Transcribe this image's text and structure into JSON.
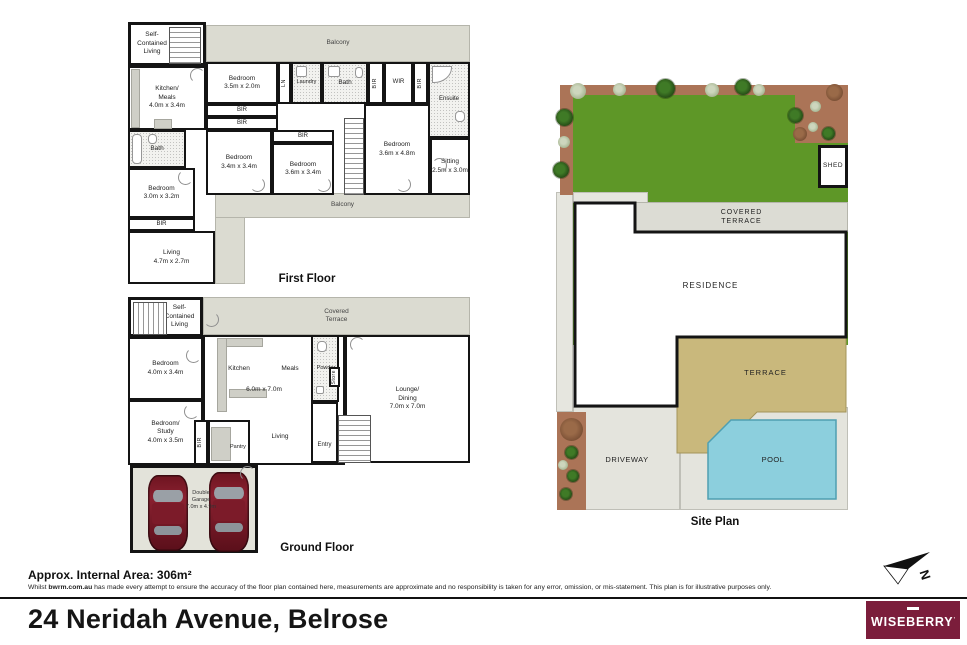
{
  "colors": {
    "wall": "#141414",
    "balcony_grey": "#dbdbd1",
    "grass_green": "#5e9727",
    "garden_brown": "#ab7457",
    "terrace_tan": "#c9b87c",
    "pool_blue": "#8ccfdd",
    "driveway_grey": "#e4e4dd",
    "car_maroon": "#6d1420",
    "logo_maroon": "#7b1d3b"
  },
  "first_floor": {
    "title": "First Floor",
    "rooms": {
      "self_contained": "Self-\nContained\nLiving",
      "balcony_top": "Balcony",
      "kitchen_meals": "Kitchen/\nMeals\n4.0m x 3.4m",
      "bedroom1": "Bedroom\n3.5m x 2.0m",
      "ln": "LN",
      "laundry": "Laundry",
      "bath_mid": "Bath",
      "bir1": "BIR",
      "wir": "WIR",
      "bir2": "BIR",
      "ensuite": "Ensuite",
      "bir_a": "BIR",
      "bir_b": "BIR",
      "bir_c": "BIR",
      "bedroom2": "Bedroom\n3.4m x 3.4m",
      "bedroom3": "Bedroom\n3.6m x 3.4m",
      "bedroom4": "Bedroom\n3.6m x 4.8m",
      "sitting": "Sitting\n2.5m x 3.0m",
      "bath_left": "Bath",
      "bedroom5": "Bedroom\n3.0m x 3.2m",
      "bir_d": "BIR",
      "living": "Living\n4.7m x 2.7m",
      "balcony_bottom": "Balcony"
    }
  },
  "ground_floor": {
    "title": "Ground Floor",
    "rooms": {
      "self_contained": "Self-\nContained\nLiving",
      "covered_terrace": "Covered\nTerrace",
      "bedroom": "Bedroom\n4.0m x 3.4m",
      "kitchen": "Kitchen",
      "meals": "Meals",
      "open_dim": "6.0m x 7.0m",
      "powder": "Powder",
      "store": "Store",
      "lounge_dining": "Lounge/\nDining\n7.0m x 7.0m",
      "bedroom_study": "Bedroom/\nStudy\n4.0m x 3.5m",
      "bir": "BIR",
      "pantry": "Pantry",
      "living": "Living",
      "entry": "Entry",
      "garage": "Double\nGarage\n7.0m x 4.9m"
    }
  },
  "site_plan": {
    "title": "Site Plan",
    "labels": {
      "shed": "SHED",
      "covered_terrace": "COVERED\nTERRACE",
      "residence": "RESIDENCE",
      "terrace": "TERRACE",
      "driveway": "DRIVEWAY",
      "pool": "POOL"
    },
    "north_label": "N"
  },
  "footer": {
    "area": "Approx. Internal Area: 306m²",
    "disclaimer_prefix": "Whilst ",
    "disclaimer_bold": "bwrm.com.au",
    "disclaimer_rest": " has made every attempt to ensure the accuracy of the floor plan contained here, measurements are approximate and no responsibility is taken for any error, omission, or mis-statement. This plan is for illustrative purposes only.",
    "address": "24 Neridah Avenue, Belrose",
    "logo": "WISEBERRY",
    "logo_mark": "’"
  }
}
